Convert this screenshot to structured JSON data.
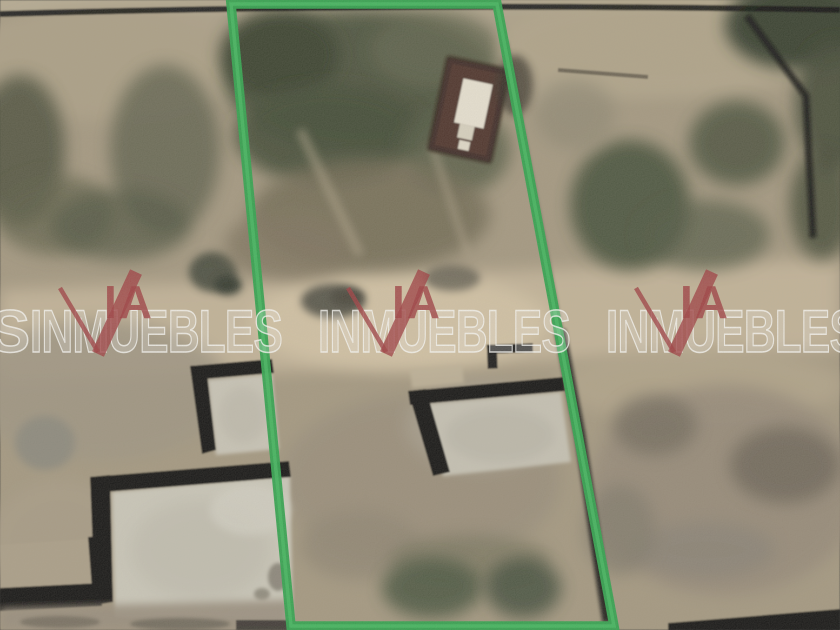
{
  "image": {
    "kind": "satellite-aerial-photo",
    "subject": "vacant land parcel outlined in green between neighboring lots with concrete slabs, walls and dirt terrain",
    "width_px": 840,
    "height_px": 630
  },
  "boundary": {
    "color": "#2ba24a",
    "vertices": 4
  },
  "watermark": {
    "edge_letter": "S",
    "ia_text": "IA",
    "main_text": "INMUEBLES",
    "red_color": "#9e393d",
    "white_color": "#ffffff",
    "instances": 3
  },
  "palette": {
    "dirt": "#a3977f",
    "light_clearing": "#d4c4a6",
    "vegetation_dark": "#3d4631",
    "concrete_slab": "#cbc8ba",
    "wall_black": "#0d0d0d",
    "building_roof_white": "#e9e3d3",
    "building_dark": "#3a2823"
  }
}
